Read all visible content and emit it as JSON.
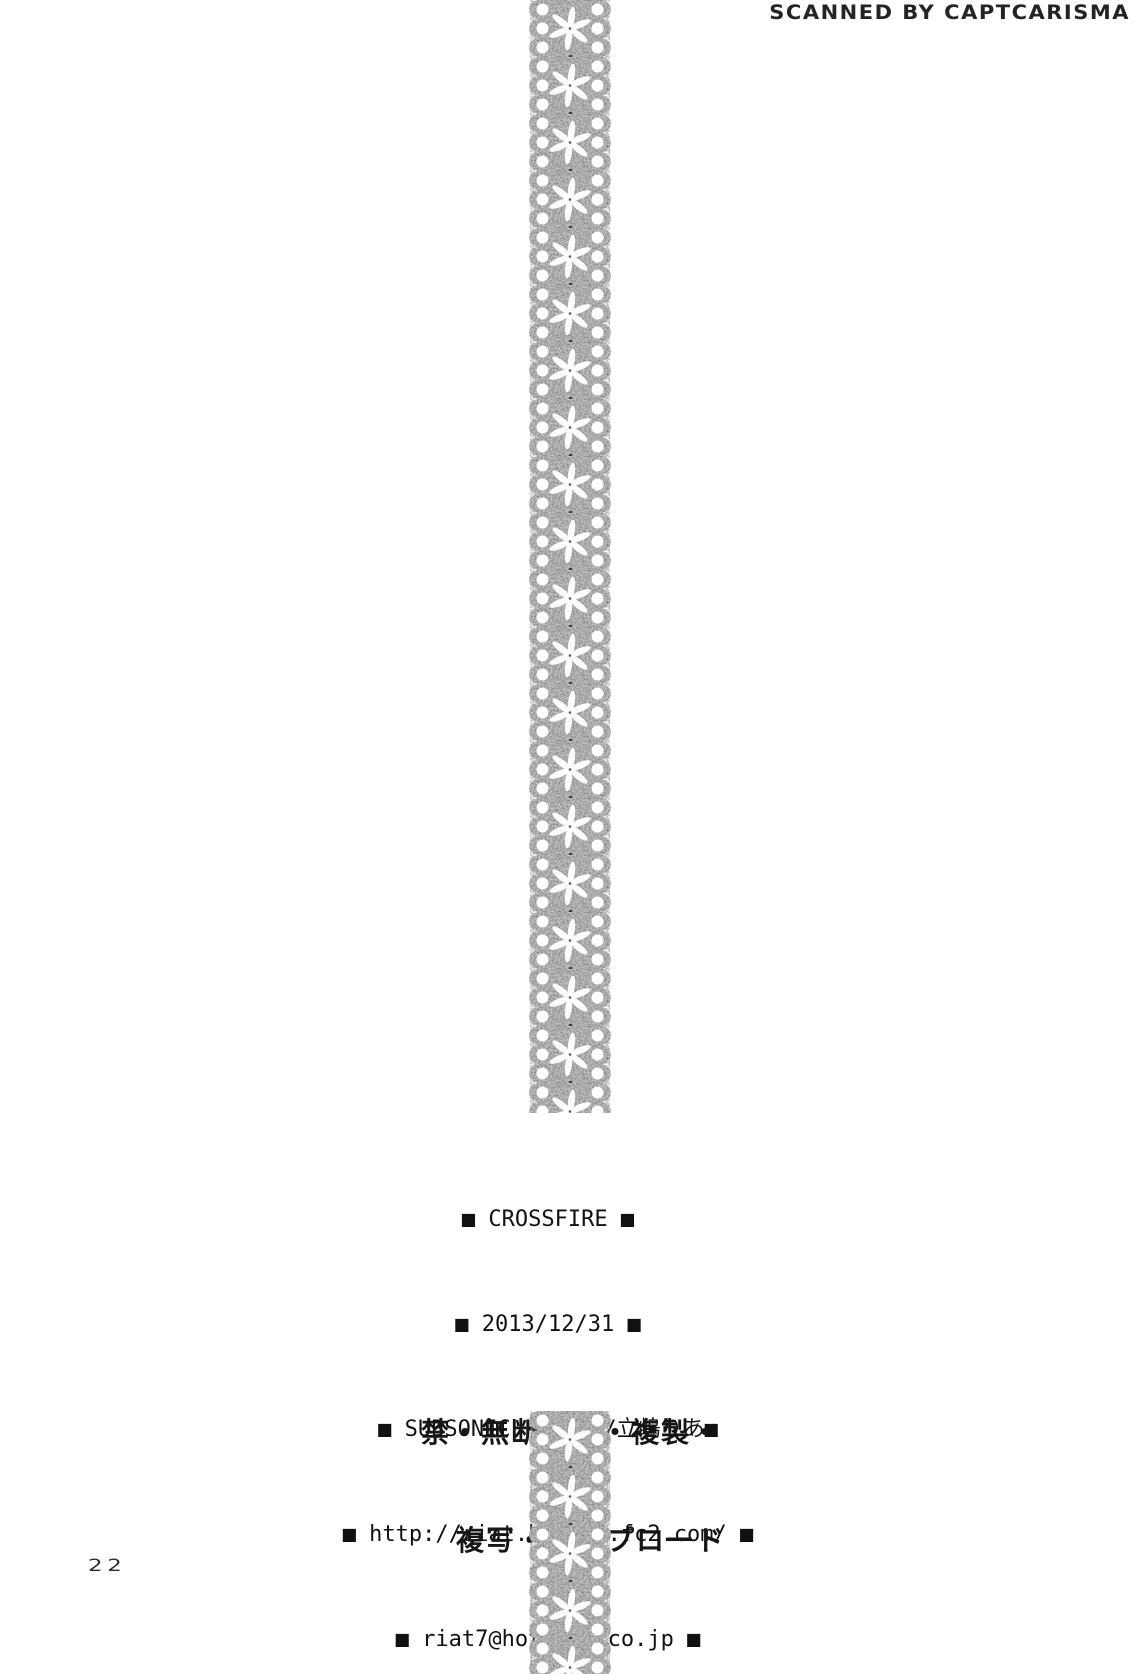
{
  "page": {
    "scanner_credit": "SCANNED BY CAPTCARISMA",
    "page_number": "22"
  },
  "credits": {
    "title": "■ CROSSFIRE ■",
    "date": "■ 2013/12/31 ■",
    "circle": "■ SUBSONIC FACTOR/立嶋りあ■",
    "website": "■ http://riat.blog88.fc2.com/ ■",
    "email": "■ riat7@hotmail.co.jp ■"
  },
  "warning": {
    "line1": "禁・無断転載・複製・",
    "line2": "複写・アップロード"
  },
  "decor": {
    "ribbon": "lace-ribbon",
    "ribbon_base_color": "#b8b8b8",
    "text_color": "#111111",
    "page_background": "#ffffff"
  }
}
